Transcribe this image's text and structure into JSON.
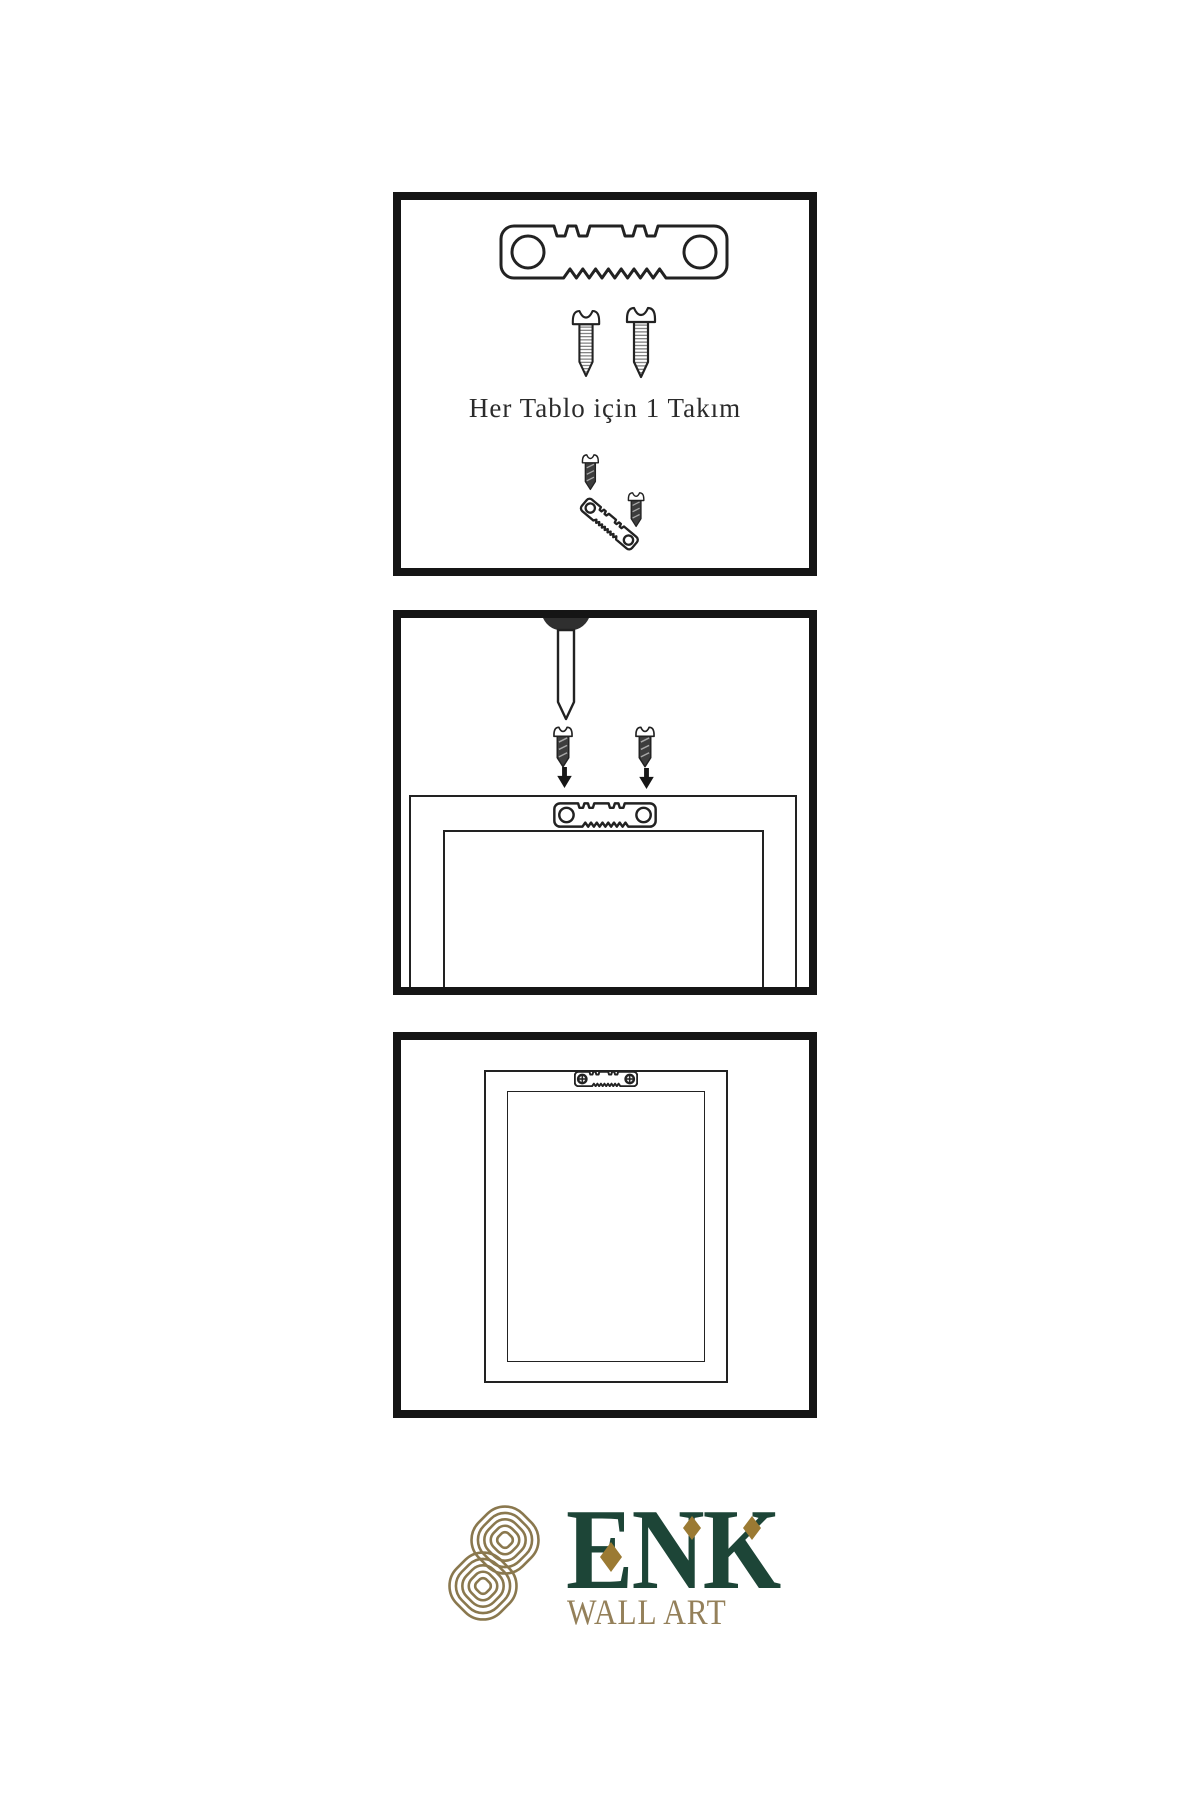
{
  "document": {
    "type": "wall-art-hanging-instruction-sheet"
  },
  "step1": {
    "caption": "Her Tablo için 1 Takım"
  },
  "logo": {
    "brand": "ENK",
    "tagline": "WALL ART"
  },
  "icons": {
    "hanger": "sawtooth-hanger",
    "screw_outline": "mounting-screw",
    "screw_dark": "mounting-screw-dark",
    "nail": "wall-nail",
    "arrow": "down-arrow",
    "phillips": "phillips-screw-head",
    "knot": "interlaced-knot-logo",
    "diamond": "diamond-accent"
  },
  "colors": {
    "background": "#ffffff",
    "panel_border": "#151515",
    "ink": "#222222",
    "screw_dark": "#3d3d3d",
    "logo_knot": "#8a784e",
    "logo_green": "#1d4537",
    "logo_gold": "#94805a",
    "logo_diamond": "#9b7a33"
  }
}
